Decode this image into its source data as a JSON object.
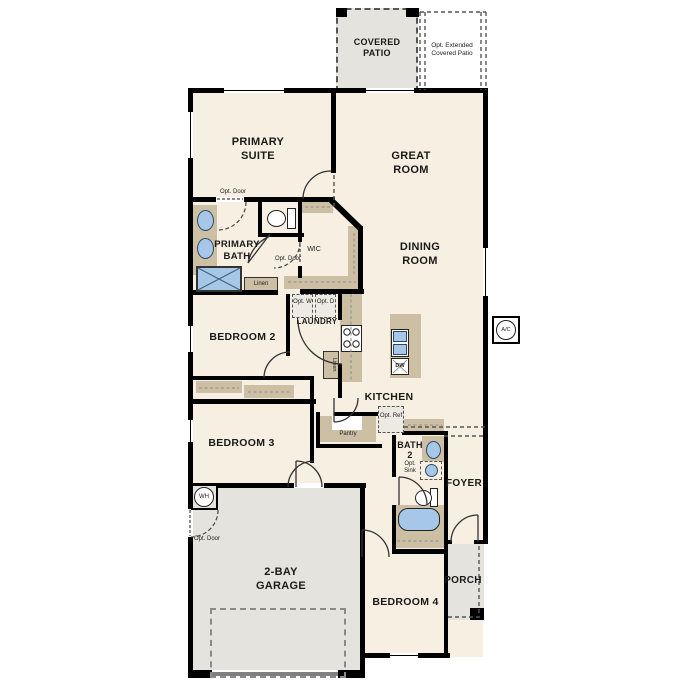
{
  "colors": {
    "floor": "#f7efe1",
    "concrete": "#e4e3dd",
    "cabinet": "#cdbfa3",
    "fixture_blue": "#a6c7e7",
    "wall": "#000000"
  },
  "rooms": {
    "covered_patio": "COVERED PATIO",
    "opt_extended_patio": "Opt. Extended Covered Patio",
    "primary_suite": "PRIMARY SUITE",
    "great_room": "GREAT ROOM",
    "dining_room": "DINING ROOM",
    "primary_bath": "PRIMARY BATH",
    "wic": "WIC",
    "laundry": "LAUNDRY",
    "bedroom_2": "BEDROOM 2",
    "bedroom_3": "BEDROOM 3",
    "bedroom_4": "BEDROOM 4",
    "kitchen": "KITCHEN",
    "bath_2": "BATH 2",
    "foyer": "FOYER",
    "porch": "PORCH",
    "garage": "2-BAY GARAGE"
  },
  "labels": {
    "opt_door": "Opt. Door",
    "linen": "Linen",
    "pantry": "Pantry",
    "opt_w": "Opt. W",
    "opt_d": "Opt. D",
    "opt_ref": "Opt. Ref",
    "opt_sink": "Opt. Sink",
    "dw": "DW",
    "wh": "WH",
    "ac": "A/C"
  }
}
